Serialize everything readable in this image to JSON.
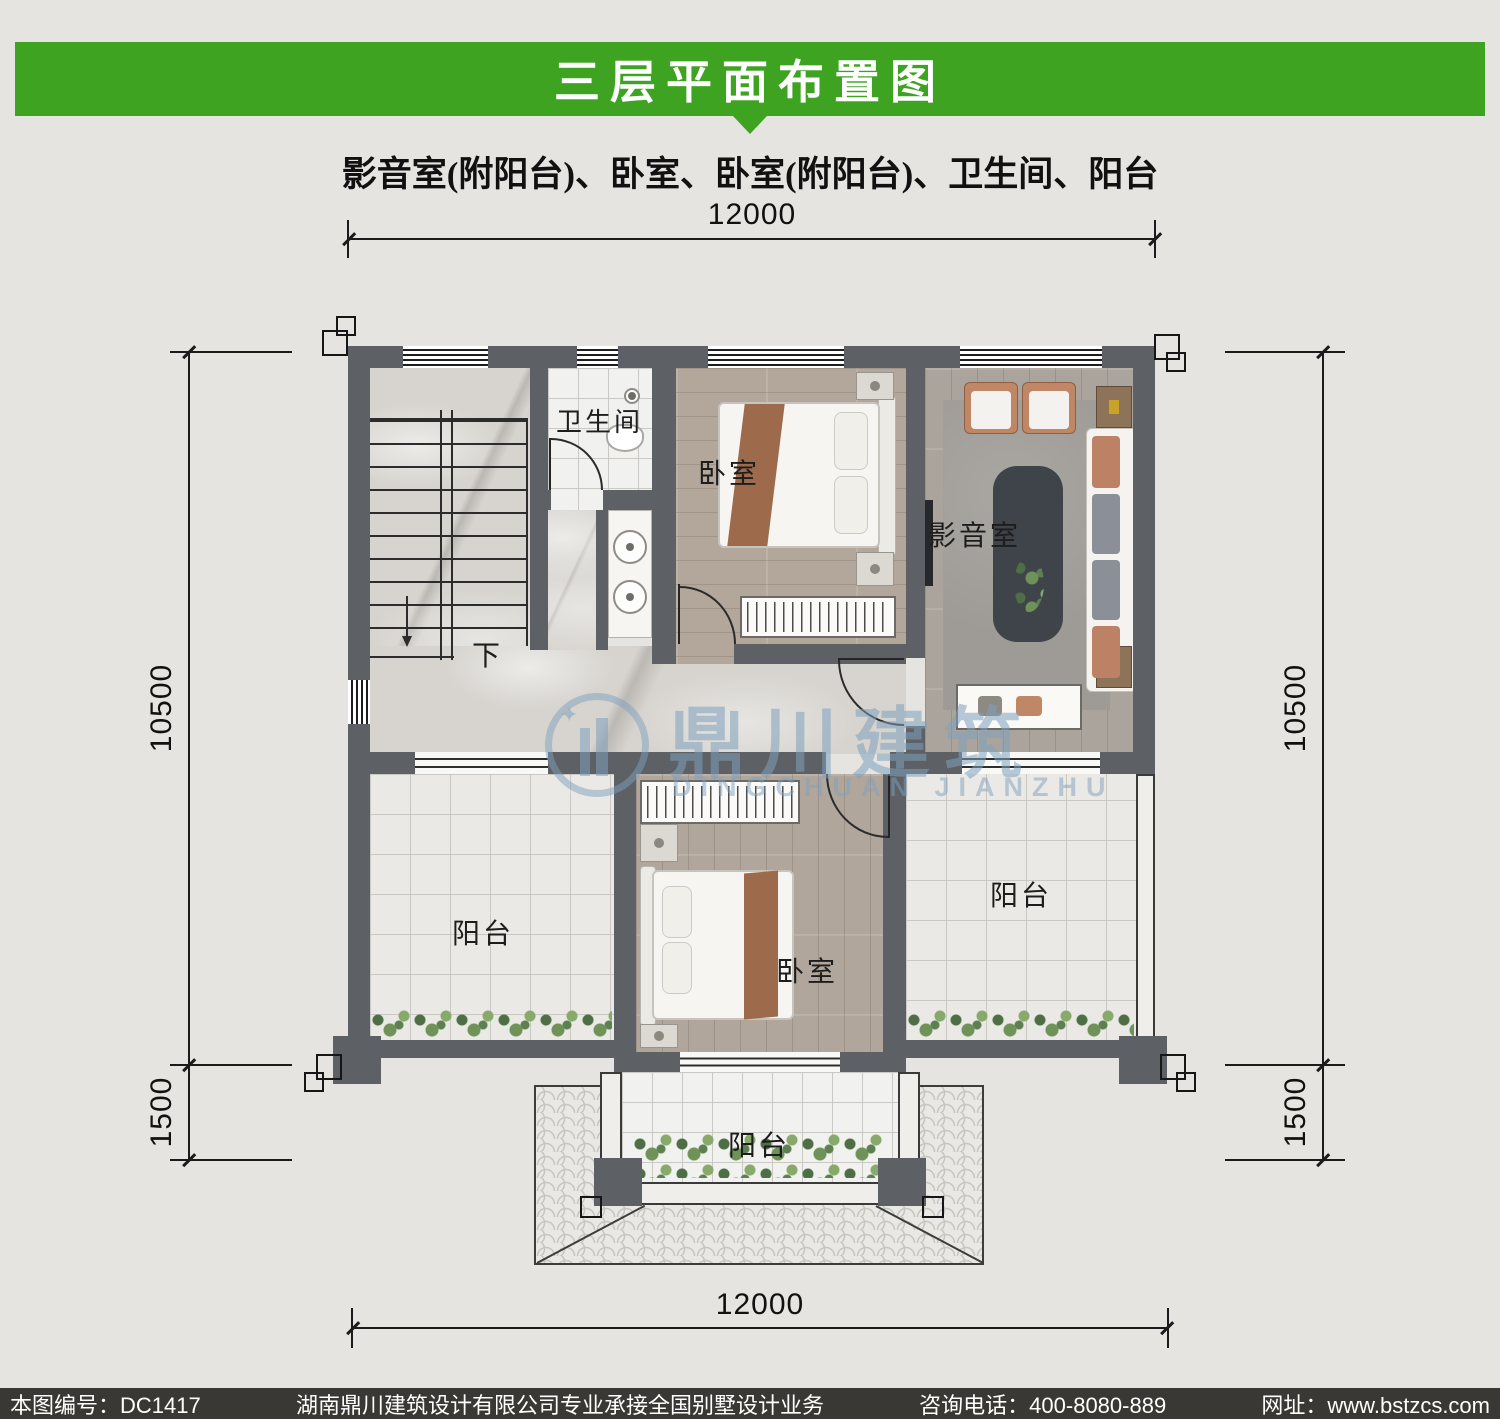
{
  "header": {
    "title": "三层平面布置图",
    "subtitle": "影音室(附阳台)、卧室、卧室(附阳台)、卫生间、阳台"
  },
  "dims": {
    "top": "12000",
    "bottom": "12000",
    "left_upper": "10500",
    "left_lower": "1500",
    "right_upper": "10500",
    "right_lower": "1500"
  },
  "rooms": {
    "bathroom": "卫生间",
    "bedroom_top": "卧室",
    "media_room": "影音室",
    "bedroom_bottom": "卧室",
    "balcony_left": "阳台",
    "balcony_right": "阳台",
    "balcony_bottom": "阳台",
    "stairs_down": "下"
  },
  "watermark": {
    "cn": "鼎川建筑",
    "en": "DINGCHUAN JIANZHU",
    "star_icon": "✦"
  },
  "footer": {
    "plan_no": "本图编号：DC1417",
    "company": "湖南鼎川建筑设计有限公司专业承接全国别墅设计业务",
    "phone": "咨询电话：400-8080-889",
    "website": "网址：www.bstzcs.com"
  },
  "colors": {
    "banner_green": "#3ea320",
    "wall_gray": "#5d6064",
    "footer_bg": "#3a3834",
    "watermark_blue": "#7da0be"
  }
}
